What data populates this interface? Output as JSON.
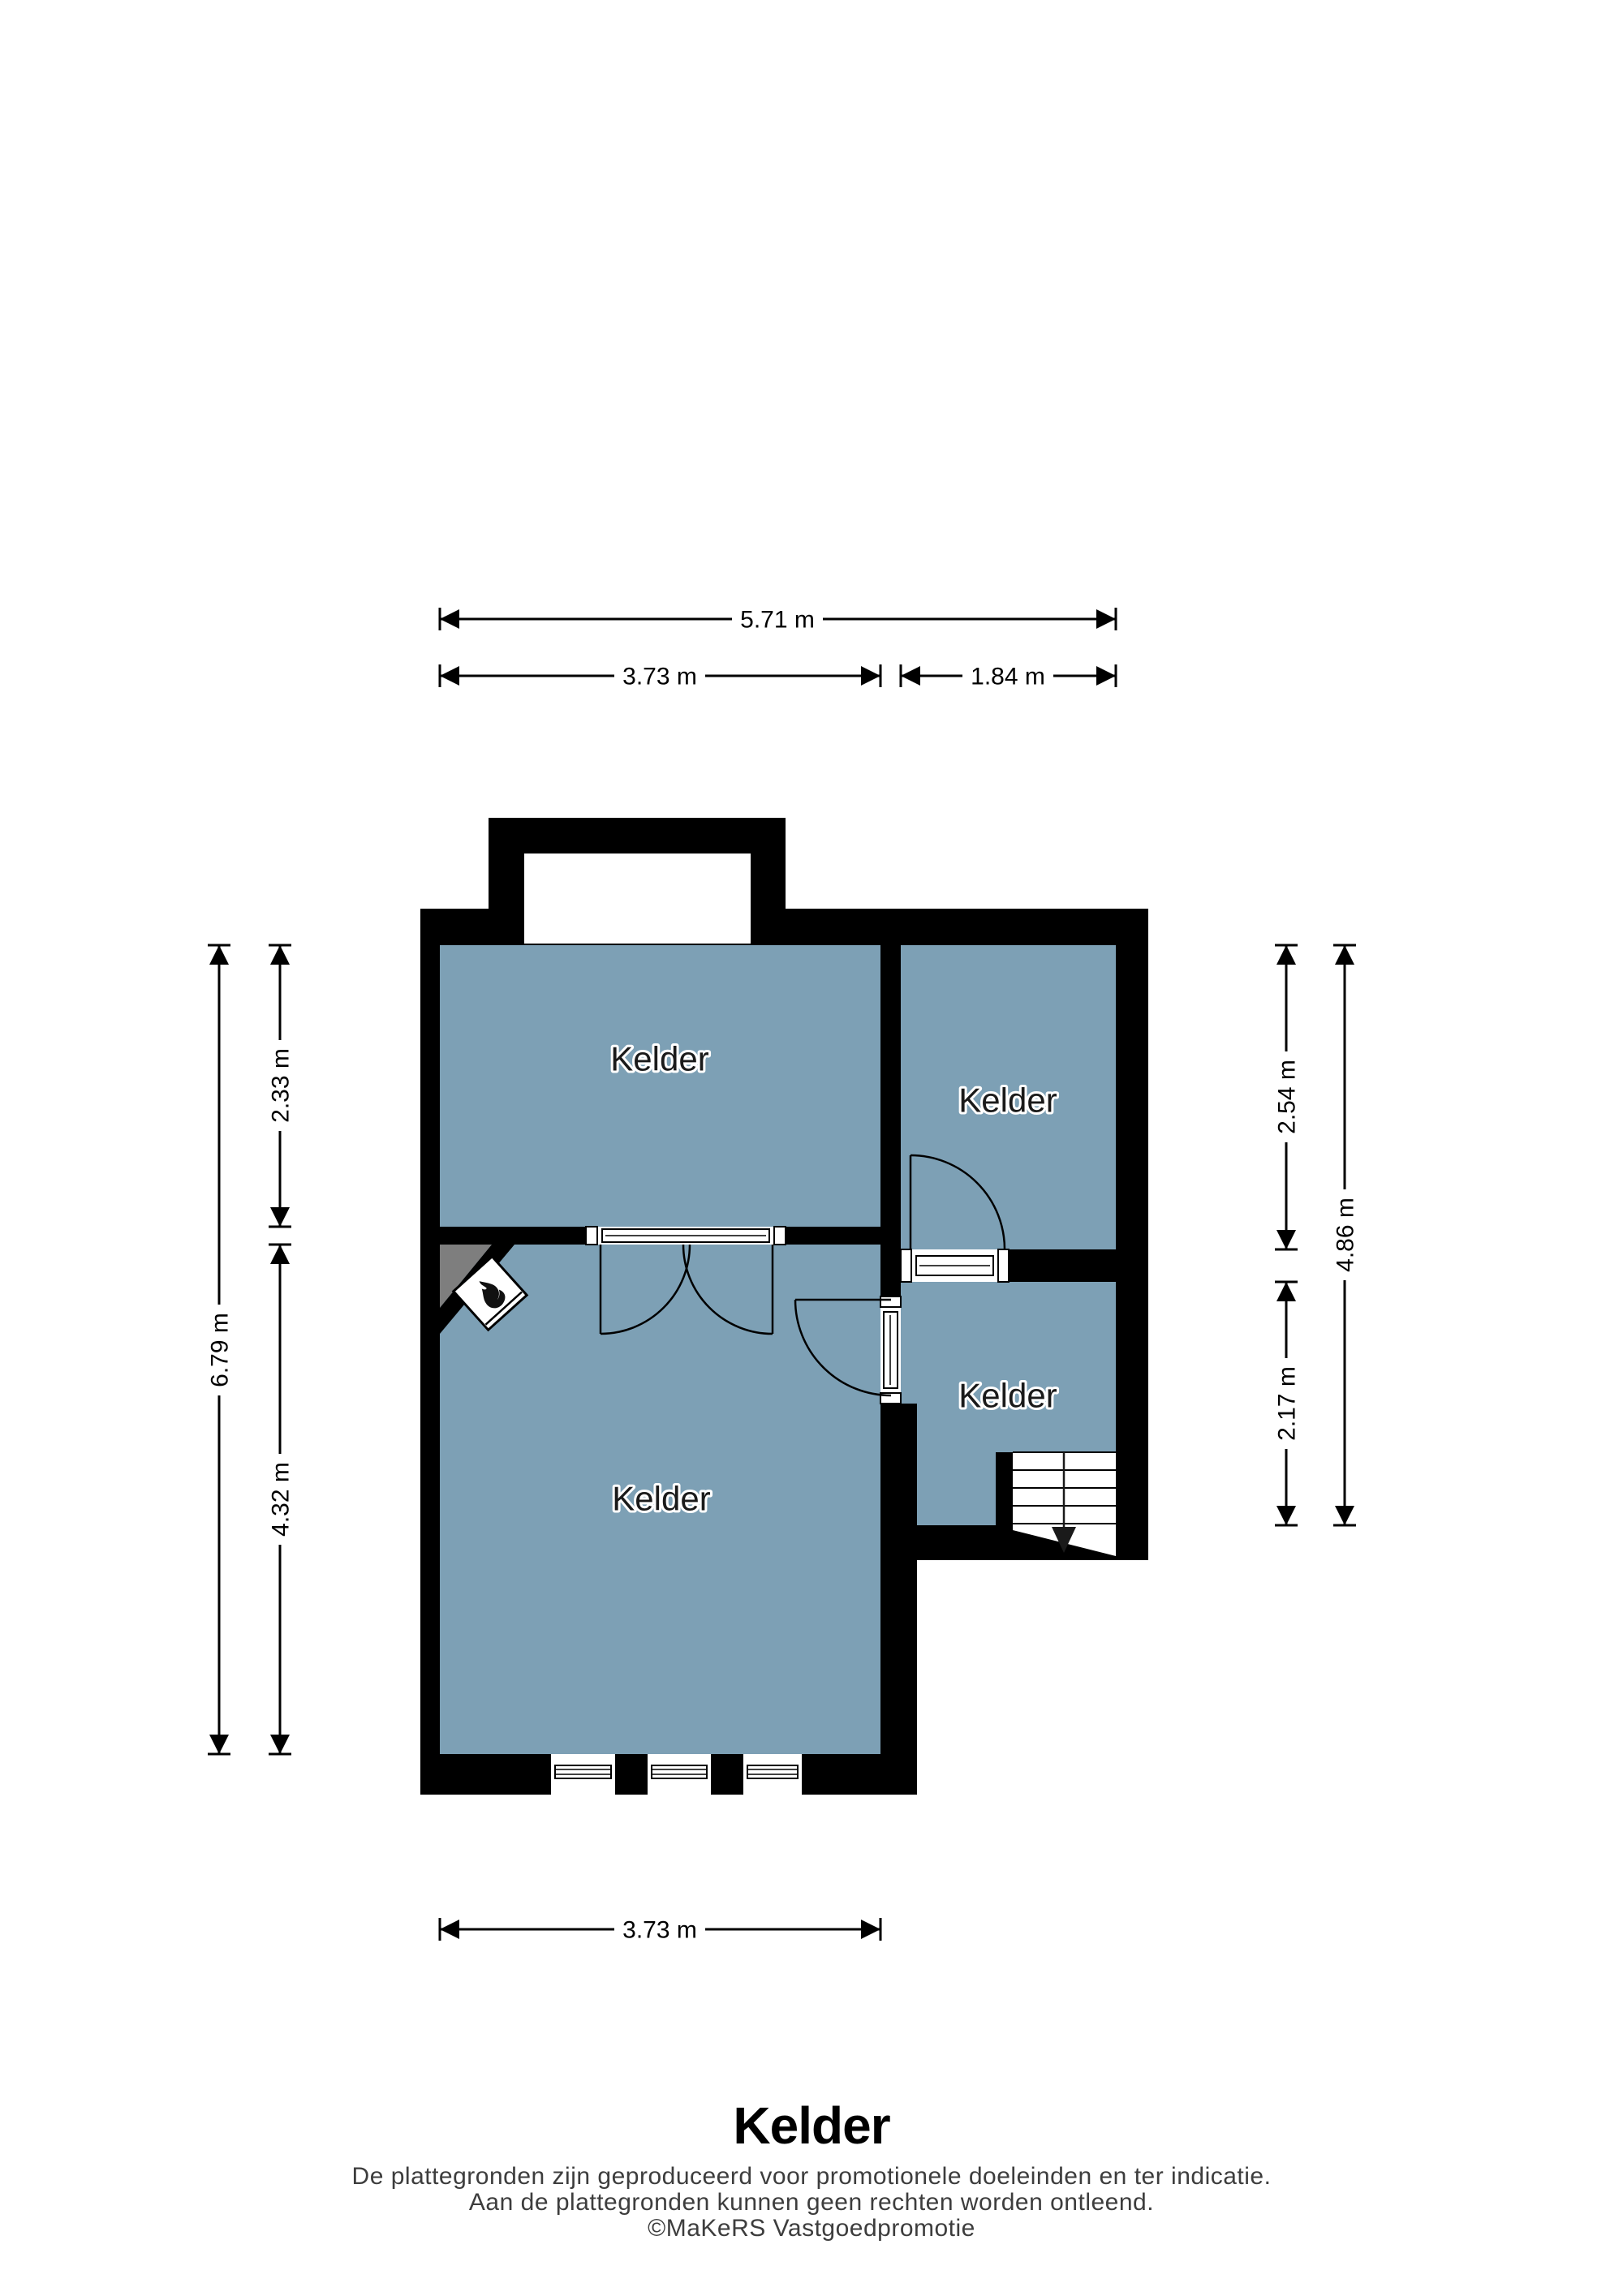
{
  "floorplan": {
    "title": "Kelder",
    "rooms": [
      {
        "id": "kelder-top-left",
        "label": "Kelder"
      },
      {
        "id": "kelder-top-right",
        "label": "Kelder"
      },
      {
        "id": "kelder-mid-right",
        "label": "Kelder"
      },
      {
        "id": "kelder-main",
        "label": "Kelder"
      }
    ],
    "dimensions": {
      "top_total": "5.71 m",
      "top_left": "3.73 m",
      "top_right": "1.84 m",
      "left_total": "6.79 m",
      "left_upper": "2.33 m",
      "left_lower": "4.32 m",
      "right_upper": "2.54 m",
      "right_lower": "2.17 m",
      "right_total": "4.86 m",
      "bottom": "3.73 m"
    },
    "icons": [
      {
        "name": "flame-icon",
        "meaning": "stove / fireplace in corner"
      },
      {
        "name": "stairs-down-arrow",
        "meaning": "staircase going down"
      }
    ],
    "colors": {
      "room_fill": "#7DA0B5",
      "wall": "#000000",
      "corner_shade": "#7E7E7E",
      "background": "#FFFFFF"
    }
  },
  "footer": {
    "disclaimer_line1": "De plattegronden zijn geproduceerd voor promotionele doeleinden en ter indicatie.",
    "disclaimer_line2": "Aan de plattegronden kunnen geen rechten worden ontleend.",
    "copyright": "©MaKeRS Vastgoedpromotie"
  }
}
